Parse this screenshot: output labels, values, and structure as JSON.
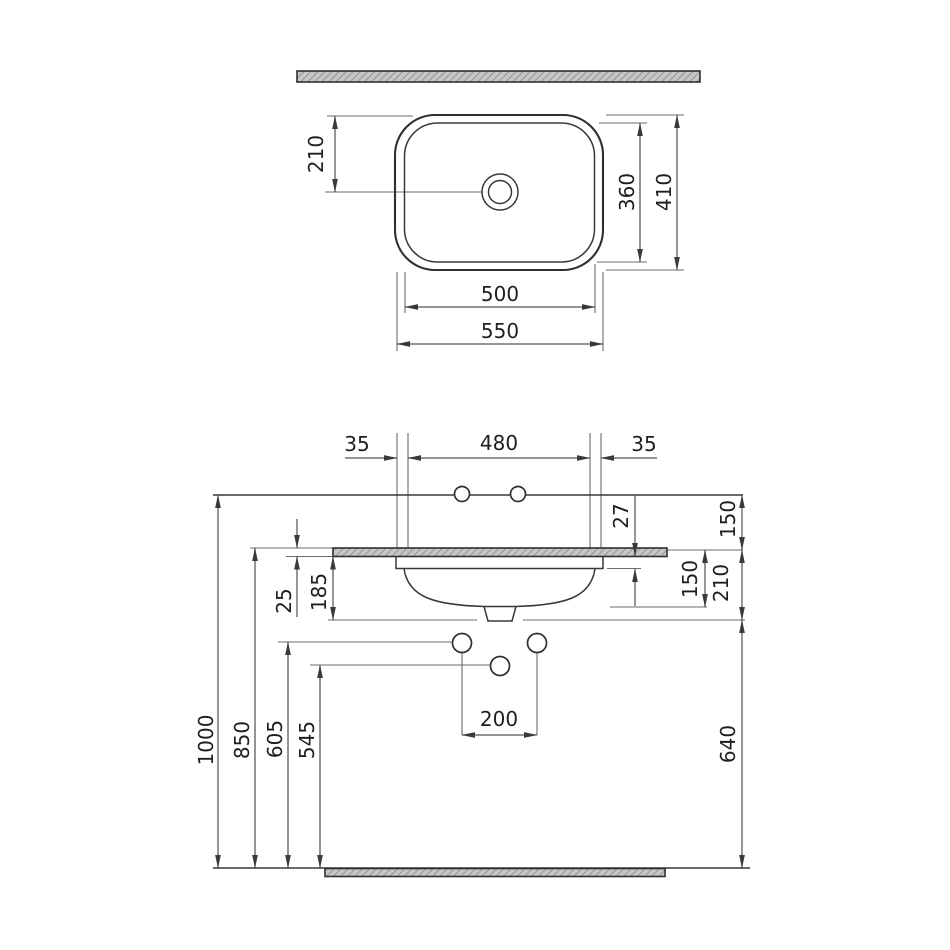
{
  "drawing_type": "washbasin-dimension-drawing",
  "colors": {
    "object_line": "#2f2f2f",
    "dimension_line": "#565656",
    "extension_line": "#6b6b6b",
    "hatch_fill": "#c6c6c6",
    "hatch_stroke": "#8c8c8c",
    "text": "#1f1f1f",
    "background": "#ffffff"
  },
  "top_view": {
    "drain_center_offset": "210",
    "inner_depth": "360",
    "outer_depth": "410",
    "inner_width": "500",
    "outer_width": "550"
  },
  "front_view": {
    "left_edge_offset": "35",
    "fixing_hole_span": "480",
    "right_edge_offset": "35",
    "rim_drop": "27",
    "wall_line_to_counter": "150",
    "counter_thickness": "25",
    "basin_depth_below_counter": "185",
    "bowl_depth": "150",
    "counter_to_drain_line": "210",
    "supply_spacing": "200",
    "total_height": "1000",
    "counter_height": "850",
    "supply_height": "605",
    "drain_height": "545",
    "drain_line_to_floor": "640"
  }
}
